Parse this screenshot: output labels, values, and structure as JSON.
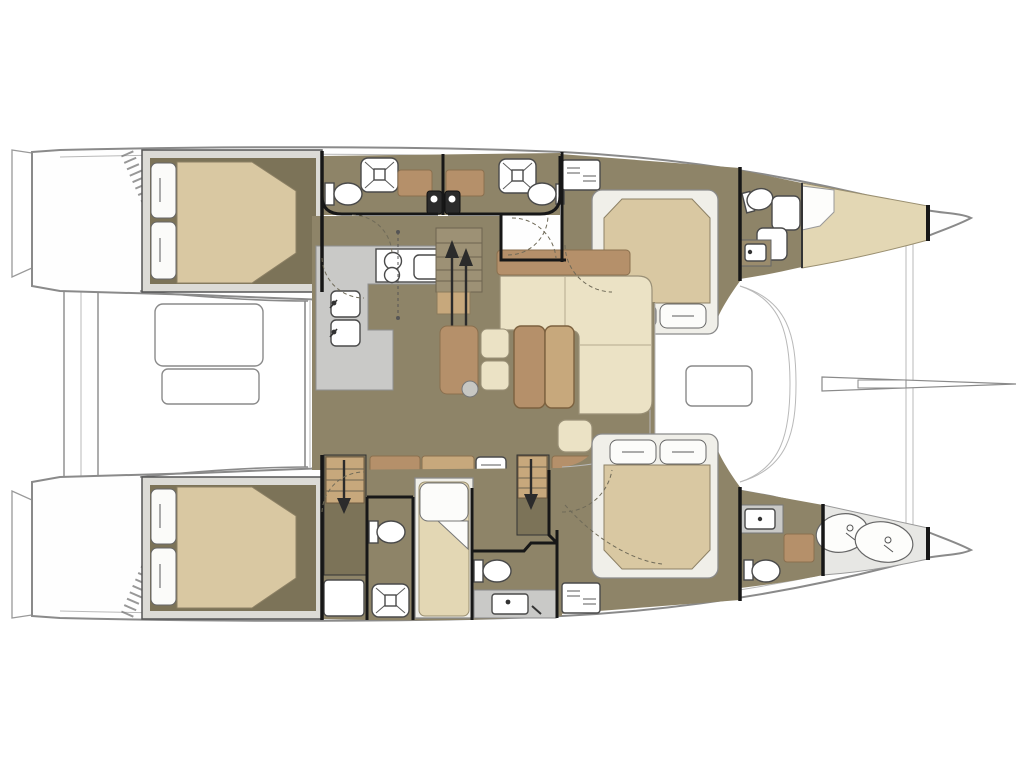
{
  "document": {
    "title": "Catamaran interior deck plan",
    "view": "top-down floor plan, bow pointing right",
    "vessel_type": "sailing catamaran, twin hulls with central salon"
  },
  "palette": {
    "background": "#ffffff",
    "floor": "#8e8468",
    "floor_dark": "#7c7358",
    "mattress": "#d9c8a2",
    "mattress_light": "#e3d7b4",
    "cream": "#ebe2c5",
    "brown": "#b5906a",
    "brown_light": "#c7a87c",
    "counter_gray": "#c9c9c7",
    "platform_gray": "#dcdbd6",
    "locker_gray": "#e7e7e4",
    "white_fixture": "#ffffff",
    "hull_line": "#8a8a8a",
    "wall": "#171717",
    "arrow": "#2b2b2b",
    "counter_dark": "#9b8c6d",
    "stool_gray": "#c7c7c3",
    "step_olive": "#9d9175"
  },
  "legend": {
    "port_hull": [
      "aft double cabin",
      "two en-suite heads with showers",
      "forward double island-bed cabin",
      "forward head with toilet and sink",
      "v-berth forepeak"
    ],
    "salon": [
      "l-shaped galley with stove and double sink",
      "chart seat with stool",
      "two dining stools",
      "dining table",
      "l-shaped sofa with ottoman",
      "companionway steps up",
      "aft cabinet row"
    ],
    "starboard_hull": [
      "aft double cabin",
      "aft head with toilet and shower",
      "single skipper berth",
      "forward head with toilet and sink counter",
      "forward double island-bed cabin",
      "bow head with sink and toilet",
      "sail locker with two sail bags"
    ],
    "deck": [
      "twin transom steps",
      "aft crossbeam platform",
      "aft cockpit bench and table",
      "forward cockpit seat",
      "forward crossbeam",
      "bowsprit"
    ]
  },
  "fixtures": {
    "double_beds": 4,
    "single_berths": 2,
    "toilets": 6,
    "showers": 3,
    "sinks": 7,
    "stove_burners": 3,
    "sail_bags": 2
  },
  "icons": [
    {
      "name": "up-arrow-icon",
      "meaning": "stairs up from salon"
    },
    {
      "name": "down-arrow-icon",
      "meaning": "stairs down into hull"
    },
    {
      "name": "shower-x-icon",
      "meaning": "shower pan"
    },
    {
      "name": "louver-icon",
      "meaning": "ventilated locker"
    }
  ]
}
